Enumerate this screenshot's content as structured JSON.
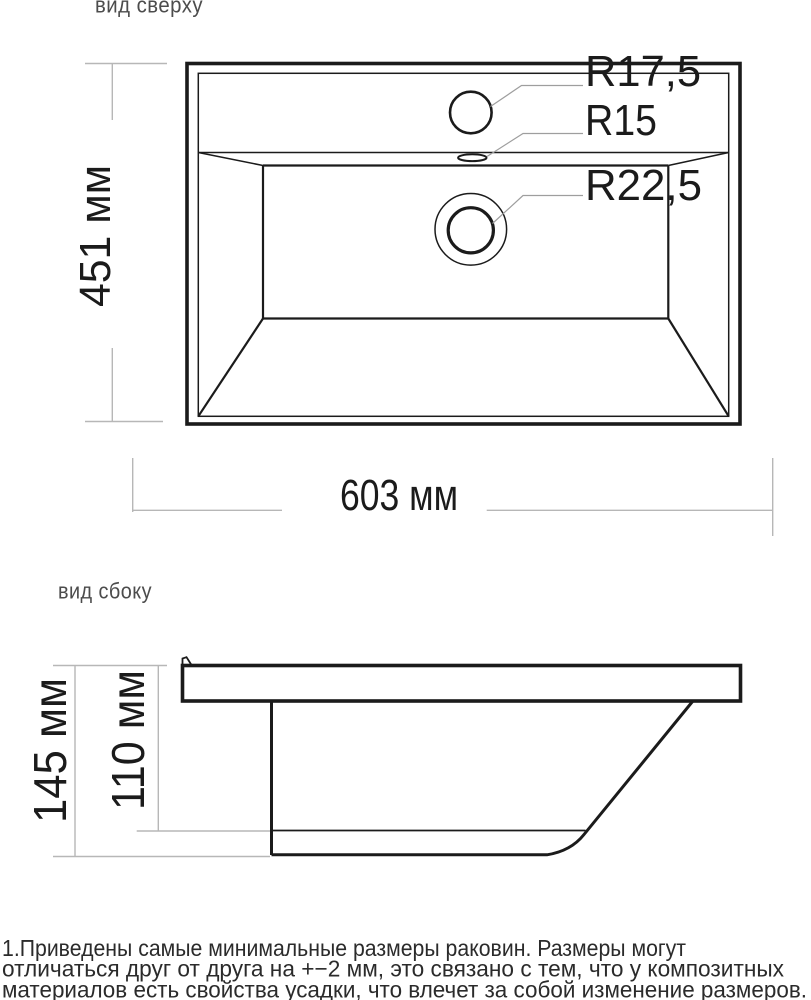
{
  "colors": {
    "drawing": "#1b1b1b",
    "dimension": "#b7b7b7",
    "leader": "#9e9e9e",
    "view_label": "#4c4c4c",
    "note": "#2b2b2b"
  },
  "top_view": {
    "label": "вид сверху",
    "radius_faucet": "R17,5",
    "radius_overflow": "R15",
    "radius_drain": "R22,5",
    "dim_depth": "451 мм",
    "dim_width": "603 мм"
  },
  "side_view": {
    "label": "вид сбоку",
    "dim_total_height": "145 мм",
    "dim_basin_height": "110 мм"
  },
  "footer": {
    "lines": [
      "1.Приведены самые минимальные размеры раковин. Размеры могут",
      "отличаться друг от друга на +−2 мм, это связано с тем, что у композитных",
      "материалов есть свойства усадки, что влечет за собой изменение размеров."
    ]
  }
}
